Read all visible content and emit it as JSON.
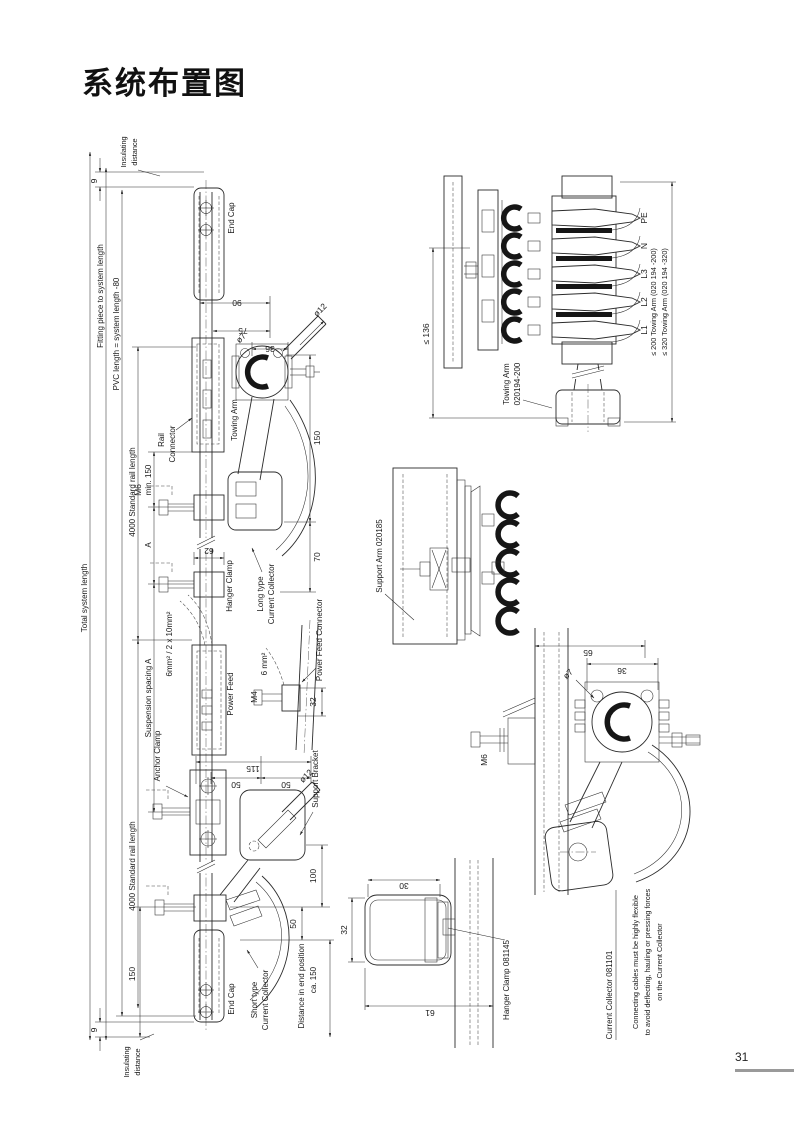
{
  "colors": {
    "ink": "#1a1a1a",
    "page_line_gray": "#9a9a9a"
  },
  "page": {
    "title": "系统布置图",
    "page_number": "31"
  },
  "ld": {
    "dims": {
      "total": "Total system length",
      "fitting": "Fitting piece to system length",
      "pvc": "PVC length = system length -80",
      "std1": "4000 Standard rail length",
      "std2": "4000 Standard rail length",
      "min150": "min. 150",
      "a": "A",
      "susp": "Suspension spacing A",
      "d9t": "9",
      "d9b": "9",
      "d90": "90",
      "d75": "75",
      "d36": "36",
      "dia12": "ø12",
      "dia7": "ø7",
      "dia12b": "ø12",
      "d150r": "150",
      "d70": "70",
      "d62": "62",
      "m6": "M6",
      "d115": "115",
      "d50a": "50",
      "d50b": "50",
      "d100": "100",
      "d50c": "50",
      "d150b": "150"
    },
    "labels": {
      "ins_top1": "Insulating",
      "ins_top2": "distance",
      "endcap_top": "End Cap",
      "rail1": "Rail",
      "rail2": "Connector",
      "towing": "Towing Arm",
      "hanger": "Hanger Clamp",
      "long1": "Long type",
      "long2": "Current Collector",
      "cable1": "6mm² / 2 x 10mm²",
      "pf": "Power Feed",
      "anchor": "Anchor Clamp",
      "support": "Support Bracket",
      "endcap_bot": "End Cap",
      "short1": "Short type",
      "short2": "Current Collector",
      "dist1": "Distance in end position",
      "dist2": "ca. 150",
      "ins_bot1": "Insulating",
      "ins_bot2": "distance"
    }
  },
  "pfd": {
    "cable": "6 mm²",
    "m4": "M4",
    "d32": "32",
    "label": "Power Feed Connector"
  },
  "cs": {
    "poles": [
      "PE",
      "N",
      "L3",
      "L2",
      "L1"
    ],
    "d136": "≤ 136",
    "arm200": "≤ 200 Towing Arm (020 194 -200)",
    "arm320": "≤ 320 Towing Arm (020 194 -320)",
    "towing1": "Towing Arm",
    "towing2": "020194-200"
  },
  "sa": {
    "label": "Support Arm 020185"
  },
  "hc": {
    "label": "Hanger Clamp 081145",
    "d30": "30",
    "d32": "32",
    "d61": "61"
  },
  "cc": {
    "label": "Current Collector 081101",
    "m6": "M6",
    "d65": "65",
    "d36": "36",
    "dia7": "ø7",
    "note1": "Connecting cables must be highly flexible",
    "note2": "to avoid deflecting, hauling or pressing forces",
    "note3": "on the Current Collector"
  }
}
